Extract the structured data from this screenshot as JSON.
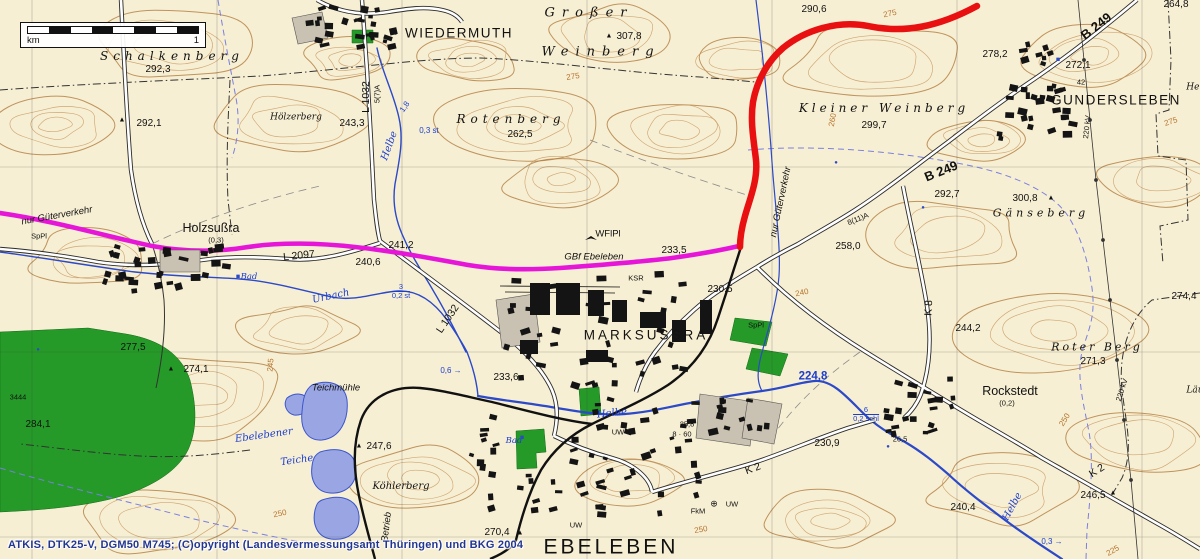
{
  "colors": {
    "background": "#f7efd3",
    "route_red": "#e81010",
    "route_magenta": "#e616d8",
    "water": "#2b49c8",
    "water_label": "#1c3ed0",
    "forest": "#259a28",
    "contour": "#c6935a",
    "building": "#141414",
    "attribution": "#23368f"
  },
  "scale_bar": {
    "unit": "km",
    "value": "1"
  },
  "attribution": "ATKIS, DTK25-V, DGM50 M745; (C)opyright (Landesvermessungsamt Thüringen) und BKG 2004",
  "map": {
    "labels": [
      {
        "text": "Schalkenberg",
        "x": 172,
        "y": 56,
        "kind": "terrain",
        "ls": 5,
        "size": 12
      },
      {
        "text": "292,3",
        "x": 158,
        "y": 70,
        "kind": "spot"
      },
      {
        "text": "292,1",
        "x": 149,
        "y": 124,
        "kind": "spot"
      },
      {
        "text": "Hölzerberg",
        "x": 296,
        "y": 118,
        "kind": "terrain-sm"
      },
      {
        "text": "WIEDERMUTH",
        "x": 459,
        "y": 33,
        "kind": "town-major"
      },
      {
        "text": "Großer",
        "x": 589,
        "y": 13,
        "kind": "terrain",
        "ls": 7,
        "size": 13
      },
      {
        "text": "Weinberg",
        "x": 601,
        "y": 52,
        "kind": "terrain",
        "ls": 7,
        "size": 13
      },
      {
        "text": "307,8",
        "x": 629,
        "y": 37,
        "kind": "spot"
      },
      {
        "text": "Rotenberg",
        "x": 511,
        "y": 119,
        "kind": "terrain",
        "ls": 5,
        "size": 12
      },
      {
        "text": "262,5",
        "x": 520,
        "y": 135,
        "kind": "spot"
      },
      {
        "text": "243,3",
        "x": 352,
        "y": 124,
        "kind": "spot"
      },
      {
        "text": "L 1032",
        "x": 366,
        "y": 97,
        "kind": "road",
        "rot": -90
      },
      {
        "text": "5(7)A",
        "x": 377,
        "y": 94,
        "kind": "small",
        "rot": -90
      },
      {
        "text": "Helbe",
        "x": 390,
        "y": 146,
        "kind": "water",
        "rot": -70
      },
      {
        "text": "1,8",
        "x": 405,
        "y": 107,
        "kind": "water-note",
        "rot": -55
      },
      {
        "text": "0,3 st",
        "x": 429,
        "y": 131,
        "kind": "water-note"
      },
      {
        "text": "290,6",
        "x": 814,
        "y": 10,
        "kind": "spot"
      },
      {
        "text": "Kleiner Weinberg",
        "x": 884,
        "y": 108,
        "kind": "terrain",
        "ls": 4,
        "size": 12
      },
      {
        "text": "299,7",
        "x": 874,
        "y": 126,
        "kind": "spot"
      },
      {
        "text": "275",
        "x": 890,
        "y": 14,
        "kind": "contour",
        "rot": -12
      },
      {
        "text": "264,8",
        "x": 1176,
        "y": 5,
        "kind": "spot"
      },
      {
        "text": "278,2",
        "x": 995,
        "y": 55,
        "kind": "spot"
      },
      {
        "text": "272,1",
        "x": 1078,
        "y": 66,
        "kind": "spot"
      },
      {
        "text": "42",
        "x": 1081,
        "y": 82,
        "kind": "small"
      },
      {
        "text": "GUNDERSLEBEN",
        "x": 1116,
        "y": 100,
        "kind": "town-major"
      },
      {
        "text": "B 249",
        "x": 1096,
        "y": 26,
        "kind": "road-b",
        "rot": -38
      },
      {
        "text": "B 249",
        "x": 941,
        "y": 171,
        "kind": "road-b",
        "rot": -22
      },
      {
        "text": "292,7",
        "x": 947,
        "y": 195,
        "kind": "spot"
      },
      {
        "text": "300,8",
        "x": 1025,
        "y": 199,
        "kind": "spot"
      },
      {
        "text": "Gänseberg",
        "x": 1041,
        "y": 213,
        "kind": "terrain",
        "ls": 4
      },
      {
        "text": "258,0",
        "x": 848,
        "y": 247,
        "kind": "spot"
      },
      {
        "text": "8(11)A",
        "x": 858,
        "y": 219,
        "kind": "small",
        "rot": -22
      },
      {
        "text": "K 8",
        "x": 929,
        "y": 308,
        "kind": "road",
        "rot": -87
      },
      {
        "text": "220 kV",
        "x": 1087,
        "y": 127,
        "kind": "small",
        "rot": -84
      },
      {
        "text": "220 kV",
        "x": 1122,
        "y": 390,
        "kind": "small",
        "rot": -72
      },
      {
        "text": "Her",
        "x": 1195,
        "y": 88,
        "kind": "terrain-sm"
      },
      {
        "text": "274,4",
        "x": 1184,
        "y": 297,
        "kind": "spot"
      },
      {
        "text": "Läu",
        "x": 1195,
        "y": 391,
        "kind": "terrain-sm"
      },
      {
        "text": "nur Güterverkehr",
        "x": 57,
        "y": 216,
        "kind": "note",
        "rot": -10
      },
      {
        "text": "SpPl",
        "x": 39,
        "y": 236,
        "kind": "small"
      },
      {
        "text": "Holzsußra",
        "x": 211,
        "y": 228,
        "kind": "town"
      },
      {
        "text": "(0,3)",
        "x": 216,
        "y": 240,
        "kind": "small"
      },
      {
        "text": "L 2097",
        "x": 299,
        "y": 256,
        "kind": "road",
        "rot": -6
      },
      {
        "text": "240,6",
        "x": 368,
        "y": 263,
        "kind": "spot"
      },
      {
        "text": "241,2",
        "x": 401,
        "y": 246,
        "kind": "spot"
      },
      {
        "text": "Bad",
        "x": 249,
        "y": 277,
        "kind": "water-sm"
      },
      {
        "text": "Urbach",
        "x": 331,
        "y": 297,
        "kind": "water",
        "rot": -12
      },
      {
        "text": "3",
        "sub": "0,2 st",
        "x": 401,
        "y": 291,
        "kind": "water-frac"
      },
      {
        "text": "L 1032",
        "x": 448,
        "y": 319,
        "kind": "road",
        "rot": -56
      },
      {
        "text": "0,6",
        "x": 451,
        "y": 371,
        "kind": "water-note",
        "arrow": true
      },
      {
        "text": "233,6",
        "x": 506,
        "y": 378,
        "kind": "spot"
      },
      {
        "text": "nur Güterverkehr",
        "x": 781,
        "y": 202,
        "kind": "note",
        "rot": -78
      },
      {
        "text": "GBf Ebeleben",
        "x": 594,
        "y": 257,
        "kind": "note"
      },
      {
        "text": "233,5",
        "x": 674,
        "y": 251,
        "kind": "spot"
      },
      {
        "text": "WFlPl",
        "x": 608,
        "y": 234,
        "kind": "small",
        "size": 9.5
      },
      {
        "text": "KSR",
        "x": 636,
        "y": 278,
        "kind": "small"
      },
      {
        "text": "230,5",
        "x": 720,
        "y": 290,
        "kind": "spot"
      },
      {
        "text": "MARKSUSSRA",
        "x": 646,
        "y": 335,
        "kind": "town-major",
        "ls": 3
      },
      {
        "text": "SpPl",
        "x": 756,
        "y": 325,
        "kind": "small"
      },
      {
        "text": "25,8",
        "x": 687,
        "y": 424,
        "kind": "small"
      },
      {
        "text": "8 · 60",
        "x": 682,
        "y": 434,
        "kind": "small"
      },
      {
        "text": "224,8",
        "x": 813,
        "y": 377,
        "kind": "water-big"
      },
      {
        "text": "6",
        "sub": "0,2 schl",
        "x": 866,
        "y": 414,
        "kind": "water-frac"
      },
      {
        "text": "230,9",
        "x": 827,
        "y": 444,
        "kind": "spot"
      },
      {
        "text": "26,5",
        "x": 900,
        "y": 439,
        "kind": "small"
      },
      {
        "text": "Rockstedt",
        "x": 1010,
        "y": 391,
        "kind": "town"
      },
      {
        "text": "(0,2)",
        "x": 1007,
        "y": 403,
        "kind": "small"
      },
      {
        "text": "244,2",
        "x": 968,
        "y": 329,
        "kind": "spot"
      },
      {
        "text": "Roter Berg",
        "x": 1097,
        "y": 347,
        "kind": "terrain",
        "ls": 3
      },
      {
        "text": "271,3",
        "x": 1093,
        "y": 362,
        "kind": "spot"
      },
      {
        "text": "K 2",
        "x": 1097,
        "y": 471,
        "kind": "road",
        "rot": -33
      },
      {
        "text": "246,5",
        "x": 1093,
        "y": 496,
        "kind": "spot"
      },
      {
        "text": "Helbe",
        "x": 1013,
        "y": 507,
        "kind": "water",
        "rot": -62
      },
      {
        "text": "0,3",
        "x": 1052,
        "y": 542,
        "kind": "water-note",
        "arrow": true
      },
      {
        "text": "240,4",
        "x": 963,
        "y": 508,
        "kind": "spot"
      },
      {
        "text": "K 2",
        "x": 753,
        "y": 469,
        "kind": "road",
        "rot": -20
      },
      {
        "text": "FkM",
        "x": 698,
        "y": 511,
        "kind": "small"
      },
      {
        "text": "UW",
        "x": 732,
        "y": 504,
        "kind": "small"
      },
      {
        "text": "UW",
        "x": 618,
        "y": 432,
        "kind": "small"
      },
      {
        "text": "UW",
        "x": 576,
        "y": 525,
        "kind": "small"
      },
      {
        "text": "270,4",
        "x": 497,
        "y": 533,
        "kind": "spot"
      },
      {
        "text": "EBELEBEN",
        "x": 611,
        "y": 547,
        "kind": "town-huge"
      },
      {
        "text": "Helbe",
        "x": 612,
        "y": 414,
        "kind": "water",
        "rot": -6
      },
      {
        "text": "Bad",
        "x": 514,
        "y": 441,
        "kind": "water-sm"
      },
      {
        "text": "277,5",
        "x": 133,
        "y": 348,
        "kind": "spot"
      },
      {
        "text": "274,1",
        "x": 196,
        "y": 370,
        "kind": "spot"
      },
      {
        "text": "3444",
        "x": 18,
        "y": 397,
        "kind": "small"
      },
      {
        "text": "284,1",
        "x": 38,
        "y": 425,
        "kind": "spot"
      },
      {
        "text": "Ebelebener",
        "x": 264,
        "y": 436,
        "kind": "water",
        "rot": -8
      },
      {
        "text": "Teiche",
        "x": 297,
        "y": 461,
        "kind": "water",
        "rot": -8
      },
      {
        "text": "Teichmühle",
        "x": 336,
        "y": 388,
        "kind": "note"
      },
      {
        "text": "247,6",
        "x": 379,
        "y": 447,
        "kind": "spot"
      },
      {
        "text": "Köhlerberg",
        "x": 401,
        "y": 487,
        "kind": "terrain-sm",
        "size": 10
      },
      {
        "text": "Betrieb",
        "x": 387,
        "y": 527,
        "kind": "note",
        "rot": -83
      },
      {
        "text": "275",
        "x": 573,
        "y": 77,
        "kind": "contour",
        "rot": -8
      },
      {
        "text": "260",
        "x": 833,
        "y": 120,
        "kind": "contour",
        "rot": -80
      },
      {
        "text": "240",
        "x": 802,
        "y": 293,
        "kind": "contour",
        "rot": -12
      },
      {
        "text": "250",
        "x": 1065,
        "y": 420,
        "kind": "contour",
        "rot": -58
      },
      {
        "text": "245",
        "x": 271,
        "y": 365,
        "kind": "contour",
        "rot": -85
      },
      {
        "text": "275",
        "x": 1171,
        "y": 122,
        "kind": "contour",
        "rot": -18
      },
      {
        "text": "250",
        "x": 701,
        "y": 530,
        "kind": "contour",
        "rot": -10
      },
      {
        "text": "250",
        "x": 280,
        "y": 514,
        "kind": "contour",
        "rot": -12
      },
      {
        "text": "225",
        "x": 1113,
        "y": 551,
        "kind": "contour",
        "rot": -30
      }
    ],
    "symbols": [
      {
        "type": "triangle",
        "x": 122,
        "y": 120
      },
      {
        "type": "triangle",
        "x": 609,
        "y": 36
      },
      {
        "type": "triangle",
        "x": 171,
        "y": 369
      },
      {
        "type": "triangle",
        "x": 359,
        "y": 446
      },
      {
        "type": "triangle",
        "x": 520,
        "y": 533
      },
      {
        "type": "triangle",
        "x": 1051,
        "y": 198
      },
      {
        "type": "triangle",
        "x": 1113,
        "y": 493
      },
      {
        "type": "glider",
        "x": 584,
        "y": 234
      },
      {
        "type": "substation",
        "x": 714,
        "y": 504
      },
      {
        "type": "blue-square",
        "x": 1058,
        "y": 60
      },
      {
        "type": "blue-square",
        "x": 522,
        "y": 438
      },
      {
        "type": "blue-square",
        "x": 238,
        "y": 277
      },
      {
        "type": "blue-dot",
        "x": 836,
        "y": 163
      },
      {
        "type": "blue-dot",
        "x": 923,
        "y": 208
      },
      {
        "type": "blue-dot",
        "x": 888,
        "y": 447
      },
      {
        "type": "blue-dot",
        "x": 38,
        "y": 350
      }
    ]
  }
}
